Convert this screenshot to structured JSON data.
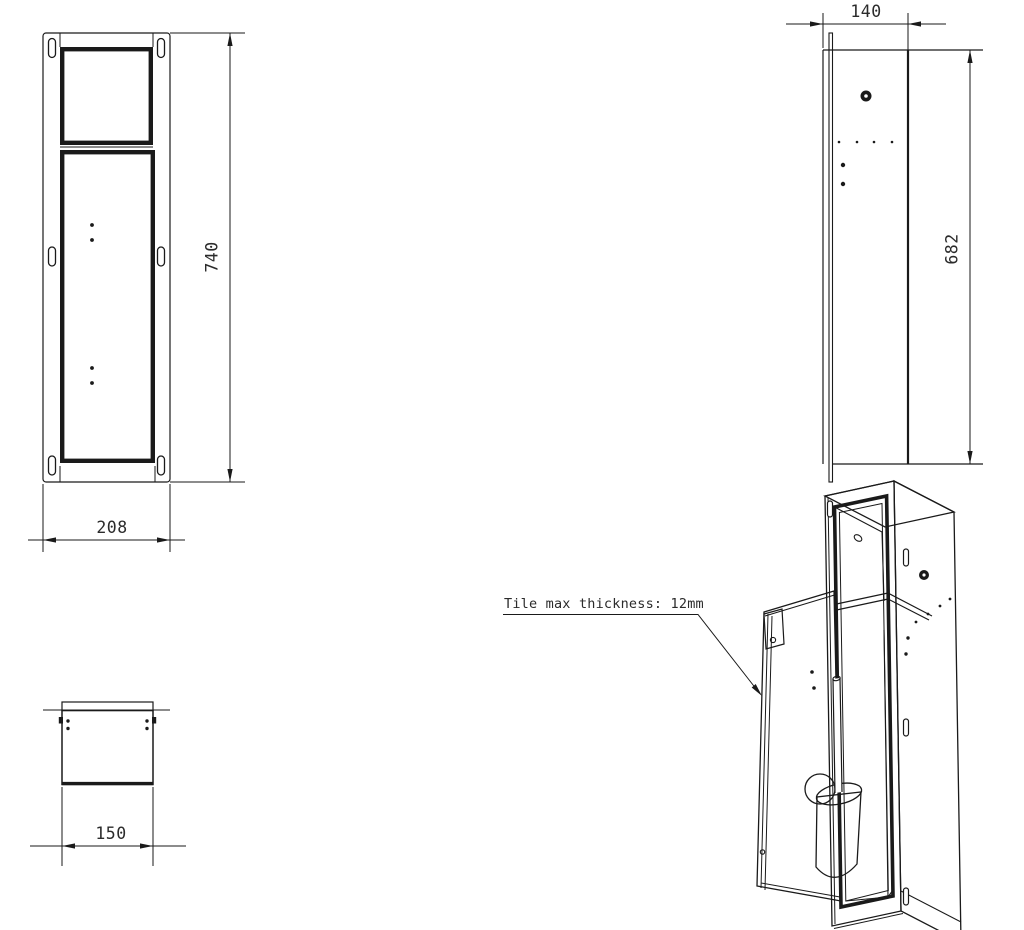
{
  "drawing": {
    "title": "recessed-toilet-brush-unit-technical-drawing",
    "front_view": {
      "height_label": "740",
      "width_label": "208"
    },
    "side_view": {
      "depth_label": "140",
      "height_label": "682"
    },
    "top_view": {
      "width_label": "150"
    },
    "iso_view": {
      "annotation": "Tile max thickness: 12mm"
    }
  },
  "colors": {
    "line": "#1a1a1a",
    "text": "#2b2b2b",
    "background": "#ffffff"
  }
}
